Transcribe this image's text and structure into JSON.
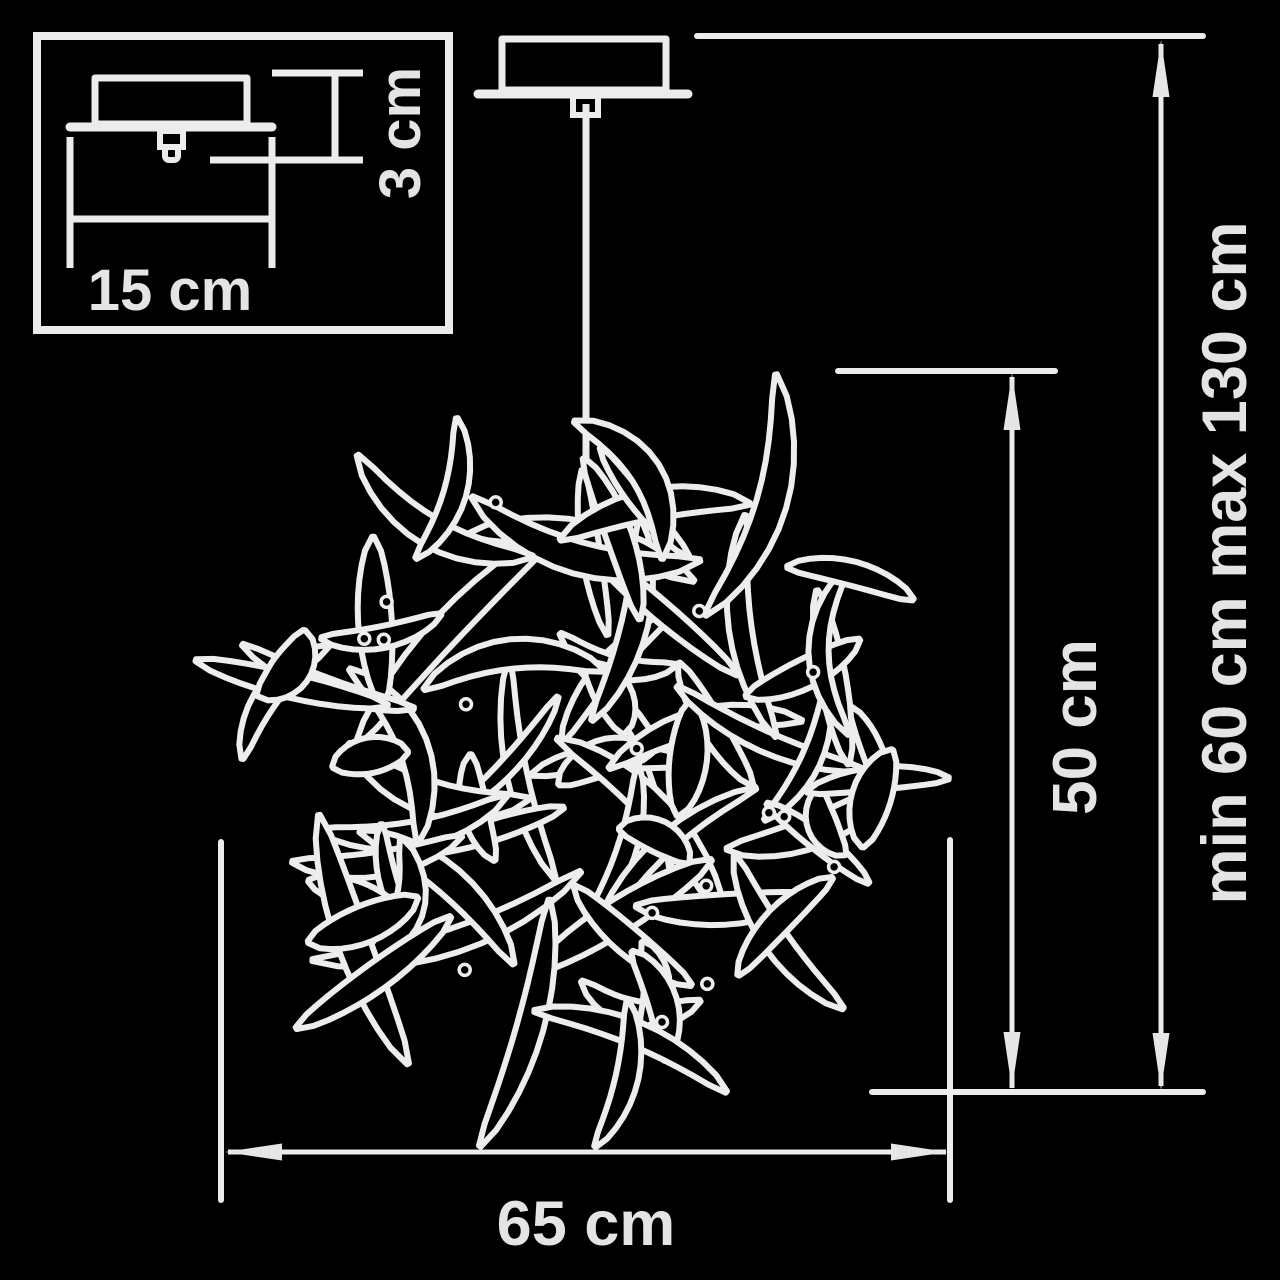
{
  "meta": {
    "description": "Pendant chandelier installation dimension diagram",
    "background_color": "#000000",
    "line_color": "#ececec"
  },
  "labels": {
    "canopy_width": "15 cm",
    "canopy_height": "3 cm",
    "shade_height": "50 cm",
    "suspension_range": "min 60 cm max 130 cm",
    "shade_diameter": "65 cm"
  }
}
